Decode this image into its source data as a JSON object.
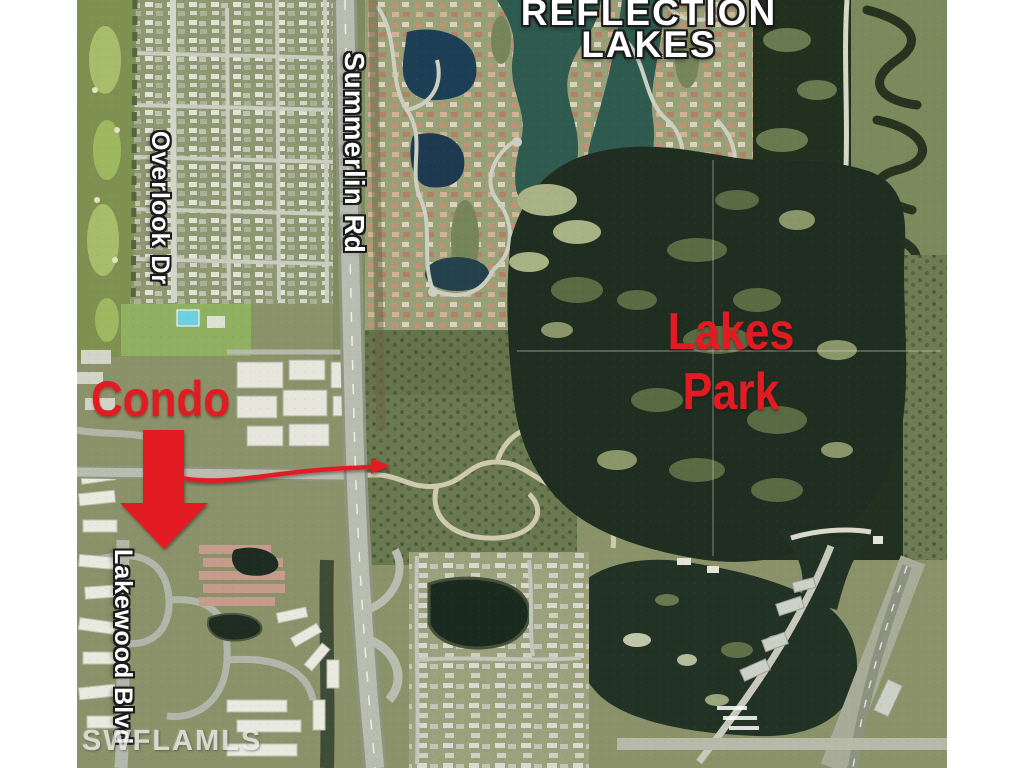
{
  "labels": {
    "community_title_line1": "REFLECTION",
    "community_title_line2": "LAKES",
    "park_name_line1": "Lakes",
    "park_name_line2": "Park",
    "annotation_condo": "Condo",
    "street_summerlin": "Summerlin Rd",
    "street_overlook": "Overlook Dr",
    "street_lakewood": "Lakewood Blvd",
    "watermark": "SWFLAMLS"
  },
  "colors": {
    "annotation_red": "#e21b23",
    "street_label_fill": "#ffffff",
    "title_fill": "#ffffff",
    "watermark_fill": "#ececea"
  }
}
